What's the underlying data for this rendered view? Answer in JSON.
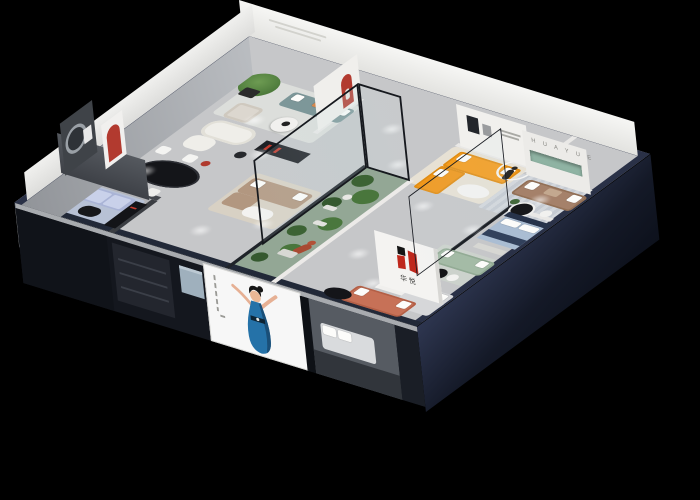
{
  "scene": {
    "description": "3D isometric cutaway render of a HUAYUE furniture showroom floor plan on a black background",
    "background_color": "#000000",
    "brand": {
      "latin_letters": "H U A Y U E",
      "chinese_name": "华悦",
      "logo_red": "#bf271c",
      "logo_black": "#141414"
    },
    "front_poster": {
      "subject": "illustrated woman in a blue evening dress with arms outstretched",
      "background": "#f7f7f7",
      "dress_color": "#2572a8",
      "side_text": "small vertical caption marks"
    },
    "palette": {
      "wall_top_navy": "#2a3147",
      "floor_gray": "#c6c7c9",
      "orange_sofa": "#f59c1c",
      "red_arch": "#b23a2f",
      "lavender_sofa": "#b4bede",
      "teal_sofa": "#7d9799",
      "sage_sofa": "#a4bba6",
      "coral_sofa": "#c77157",
      "brown_sofa": "#a5816a",
      "tan_sofa": "#b29780",
      "atrium_green": "#93a795",
      "niche_green": "#8fb3a3",
      "navy_bed_blanket": "#32415c"
    },
    "rooms": [
      {
        "name": "dining-room",
        "items": [
          "black oval dining table",
          "white chairs",
          "red arch niche",
          "dark feature wall with round art"
        ]
      },
      {
        "name": "lavender-lounge",
        "items": [
          "lavender sectional sofa",
          "black coffee table",
          "black media console with red accents",
          "blue-gray rug",
          "dark gray walls"
        ]
      },
      {
        "name": "tree-lounge",
        "items": [
          "potted tree",
          "teal sofa with white and orange pillows",
          "cream armchair",
          "round white coffee table"
        ]
      },
      {
        "name": "cream-lounge",
        "items": [
          "white curved sofa",
          "dark media cabinet with red lights",
          "red floor lamp"
        ]
      },
      {
        "name": "tan-lounge",
        "items": [
          "tan fabric sofa",
          "white coffee table",
          "beige rug"
        ]
      },
      {
        "name": "glass-atrium",
        "items": [
          "black framed glass walls",
          "green plants",
          "white pebbles",
          "terracotta mannequin at desk"
        ]
      },
      {
        "name": "orange-showroom",
        "items": [
          "orange L-shaped sofa with white pillows",
          "white oval coffee table",
          "wall art",
          "runner sculpture with white ring"
        ]
      },
      {
        "name": "huayue-lounge",
        "items": [
          "HUAYUE lettered wall",
          "green recessed shelf",
          "brown leather sofa",
          "round black coffee table",
          "striped rug"
        ]
      },
      {
        "name": "logo-lounge",
        "items": [
          "white wall with red HUAYUE logo",
          "coral sofa",
          "black oval coffee table"
        ]
      },
      {
        "name": "blue-bedroom",
        "items": [
          "navy bed with light blue bedding",
          "white pillows",
          "foot bench",
          "glass partition"
        ]
      },
      {
        "name": "sage-lounge",
        "items": [
          "sage green sofa",
          "black and white round side tables"
        ]
      },
      {
        "name": "gray-bedroom",
        "items": [
          "gray bed with white pillows seen through front cut"
        ]
      }
    ]
  }
}
